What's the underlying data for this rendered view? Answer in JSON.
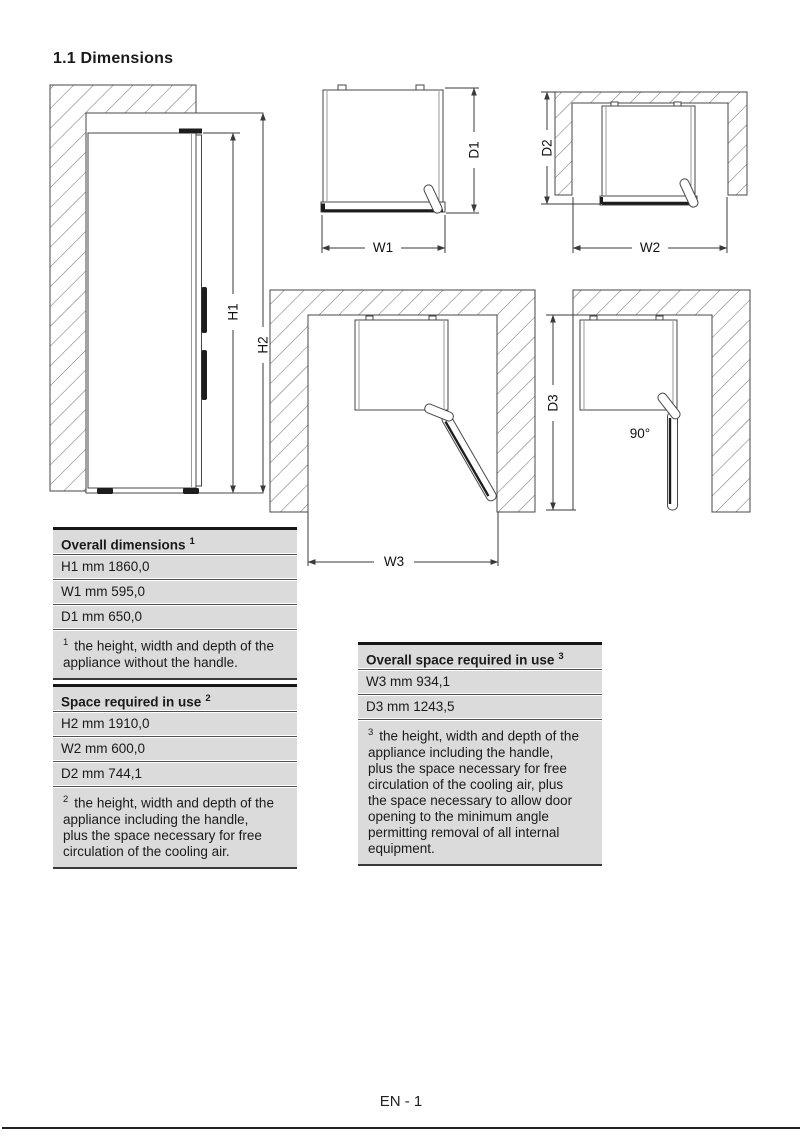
{
  "page": {
    "title": "1.1 Dimensions",
    "footer_page_label": "EN - 1"
  },
  "diagrams": {
    "side_view": {
      "h1": "H1",
      "h2": "H2"
    },
    "top_view_closed": {
      "w1": "W1",
      "d1": "D1"
    },
    "top_view_alcove": {
      "w2": "W2",
      "d2": "D2"
    },
    "top_view_door_open": {
      "w3": "W3"
    },
    "top_view_door_90": {
      "d3": "D3",
      "angle": "90°"
    }
  },
  "tables": {
    "overall_dimensions": {
      "header": {
        "label": "Overall dimensions",
        "sup": "1"
      },
      "rows": [
        "H1 mm 1860,0",
        "W1 mm 595,0",
        "D1 mm 650,0"
      ],
      "footnote": {
        "sup": "1",
        "text": "the height, width and depth of the\nappliance without the handle."
      }
    },
    "space_required_in_use": {
      "header": {
        "label": "Space required in use",
        "sup": "2"
      },
      "rows": [
        "H2 mm 1910,0",
        "W2 mm 600,0",
        "D2 mm 744,1"
      ],
      "footnote": {
        "sup": "2",
        "text": "the height, width and depth of the\nappliance including the handle,\nplus the space necessary for free\ncirculation of the cooling air."
      }
    },
    "overall_space_required_in_use": {
      "header": {
        "label": "Overall space required in use",
        "sup": "3"
      },
      "rows": [
        "W3 mm 934,1",
        "D3 mm 1243,5"
      ],
      "footnote": {
        "sup": "3",
        "text": "the height, width and depth of the\nappliance including the handle,\nplus the space necessary for free\ncirculation of the cooling air, plus\nthe space necessary to allow door\nopening to the minimum angle\npermitting removal of all internal\nequipment."
      }
    }
  },
  "colors": {
    "table_row_bg": "#dbdbdb",
    "line": "#474747",
    "text": "#1a1a1a"
  }
}
